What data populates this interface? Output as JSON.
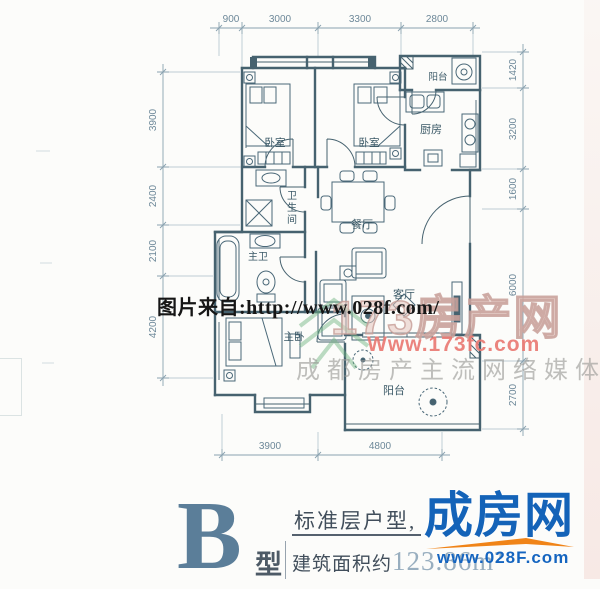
{
  "plan": {
    "rooms": [
      {
        "key": "bedroom-1",
        "label": "卧室"
      },
      {
        "key": "bedroom-2",
        "label": "卧室"
      },
      {
        "key": "kitchen",
        "label": "厨房"
      },
      {
        "key": "balcony-top",
        "label": "阳台"
      },
      {
        "key": "bathroom",
        "label": "卫生间"
      },
      {
        "key": "master-bath",
        "label": "主卫"
      },
      {
        "key": "dining",
        "label": "餐厅"
      },
      {
        "key": "living",
        "label": "客厅"
      },
      {
        "key": "master-bedroom",
        "label": "主卧"
      },
      {
        "key": "balcony-bottom",
        "label": "阳台"
      }
    ],
    "dims": {
      "top": [
        "900",
        "3000",
        "3300",
        "2800"
      ],
      "left": [
        "3900",
        "2400",
        "2100",
        "4200"
      ],
      "right": [
        "1420",
        "3200",
        "1600",
        "6000",
        "2700"
      ],
      "bottom": [
        "3900",
        "4800"
      ]
    }
  },
  "watermarks": {
    "photo_credit": "图片来自:http://www.028f.com/",
    "portal_name": "173房产网",
    "portal_url": "Www.173fc.com",
    "portal_slogan": "成都房产主流网络媒体"
  },
  "footer": {
    "type_letter": "B",
    "type_suffix": "型",
    "headline": "标准层户型,",
    "area_label": "建筑面积约",
    "area_value": "123.86m²",
    "brand_name": "成房网",
    "brand_url": "www.028F.com"
  },
  "colors": {
    "wall": "#46626f",
    "dimension": "#7d98a8",
    "type_letter": "#5b7e99",
    "brand_blue": "#1463b8",
    "brand_orange": "#f08418",
    "watermark_pink": "#e97a73",
    "watermark_gray": "#98988f"
  }
}
